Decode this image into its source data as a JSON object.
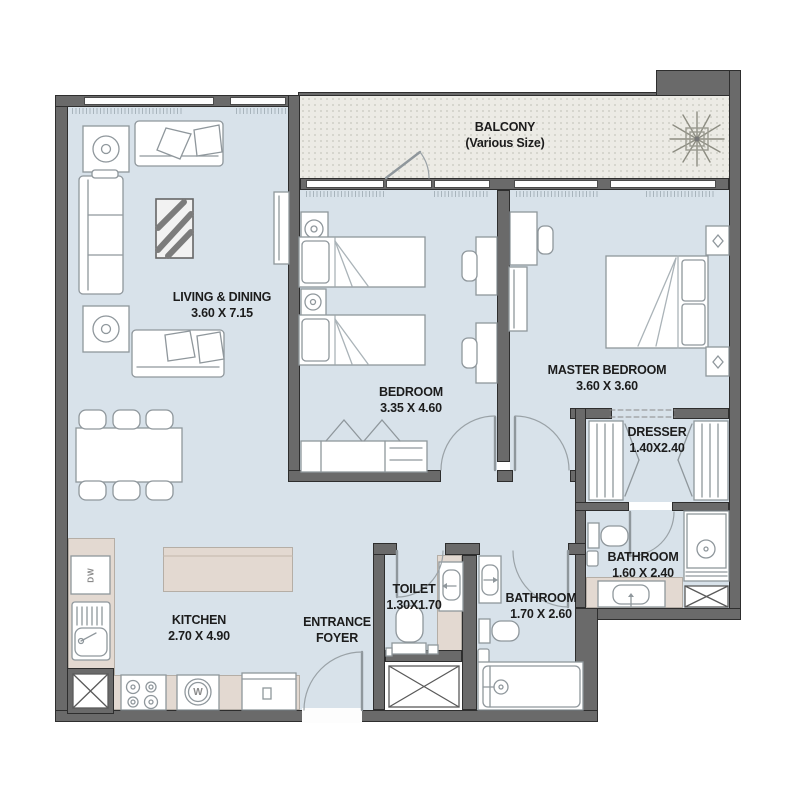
{
  "rooms": {
    "balcony": {
      "line1": "BALCONY",
      "line2": "(Various Size)"
    },
    "living_dining": {
      "line1": "LIVING & DINING",
      "line2": "3.60 X 7.15"
    },
    "bedroom": {
      "line1": "BEDROOM",
      "line2": "3.35 X 4.60"
    },
    "master_bedroom": {
      "line1": "MASTER BEDROOM",
      "line2": "3.60 X 3.60"
    },
    "dresser": {
      "line1": "DRESSER",
      "line2": "1.40X2.40"
    },
    "master_bathroom": {
      "line1": "BATHROOM",
      "line2": "1.60 X 2.40"
    },
    "toilet": {
      "line1": "TOILET",
      "line2": "1.30X1.70"
    },
    "bathroom": {
      "line1": "BATHROOM",
      "line2": "1.70 X 2.60"
    },
    "kitchen": {
      "line1": "KITCHEN",
      "line2": "2.70 X 4.90"
    },
    "entrance_foyer": {
      "line1": "ENTRANCE",
      "line2": "FOYER"
    }
  },
  "appliances": {
    "dishwasher": "DW",
    "washer": "W"
  },
  "colors": {
    "wall": "#6a6a6a",
    "floor": "#d8e2ea",
    "balcony_floor": "#ecebe5",
    "counter": "#e3d9d1",
    "furniture_outline": "#8f979c"
  }
}
